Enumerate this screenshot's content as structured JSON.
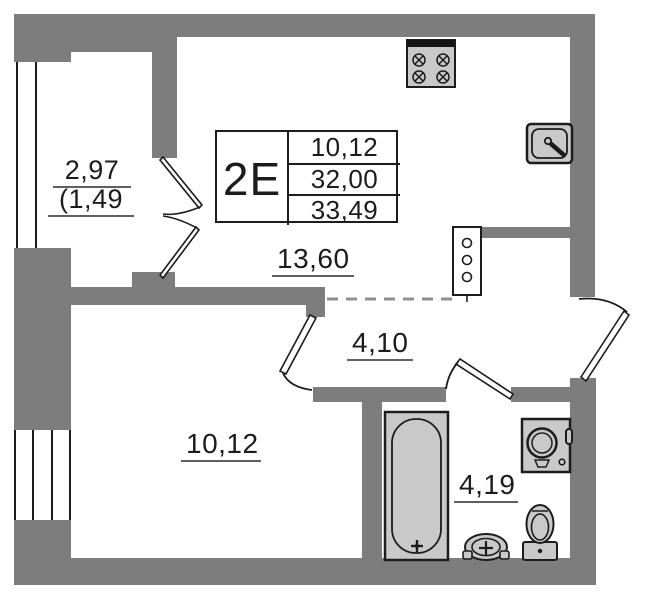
{
  "title_block": {
    "unit": "2E",
    "rows": [
      "10,12",
      "32,00",
      "33,49"
    ]
  },
  "rooms": {
    "balcony": {
      "area": "2,97",
      "area_coeff": "(1,49"
    },
    "kitchen_living": {
      "area": "13,60"
    },
    "hall": {
      "area": "4,10"
    },
    "bedroom": {
      "area": "10,12"
    },
    "bathroom": {
      "area": "4,19"
    }
  },
  "icons": [
    "stove-icon",
    "kitchen-sink-icon",
    "vent-shaft-icon",
    "balcony-door-icon",
    "room-door-icon",
    "bathroom-door-icon",
    "entrance-door-icon",
    "bathtub-icon",
    "washing-machine-icon",
    "toilet-icon",
    "bathroom-sink-icon",
    "balcony-window-icon",
    "bedroom-window-icon"
  ],
  "colors": {
    "wall": "#7d7d7d",
    "fixture": "#c9c9c9",
    "line": "#1c1c1c",
    "dash": "#8f8f8f",
    "text": "#1c1c1c",
    "underline": "#5f5f5f",
    "bg": "#ffffff"
  }
}
